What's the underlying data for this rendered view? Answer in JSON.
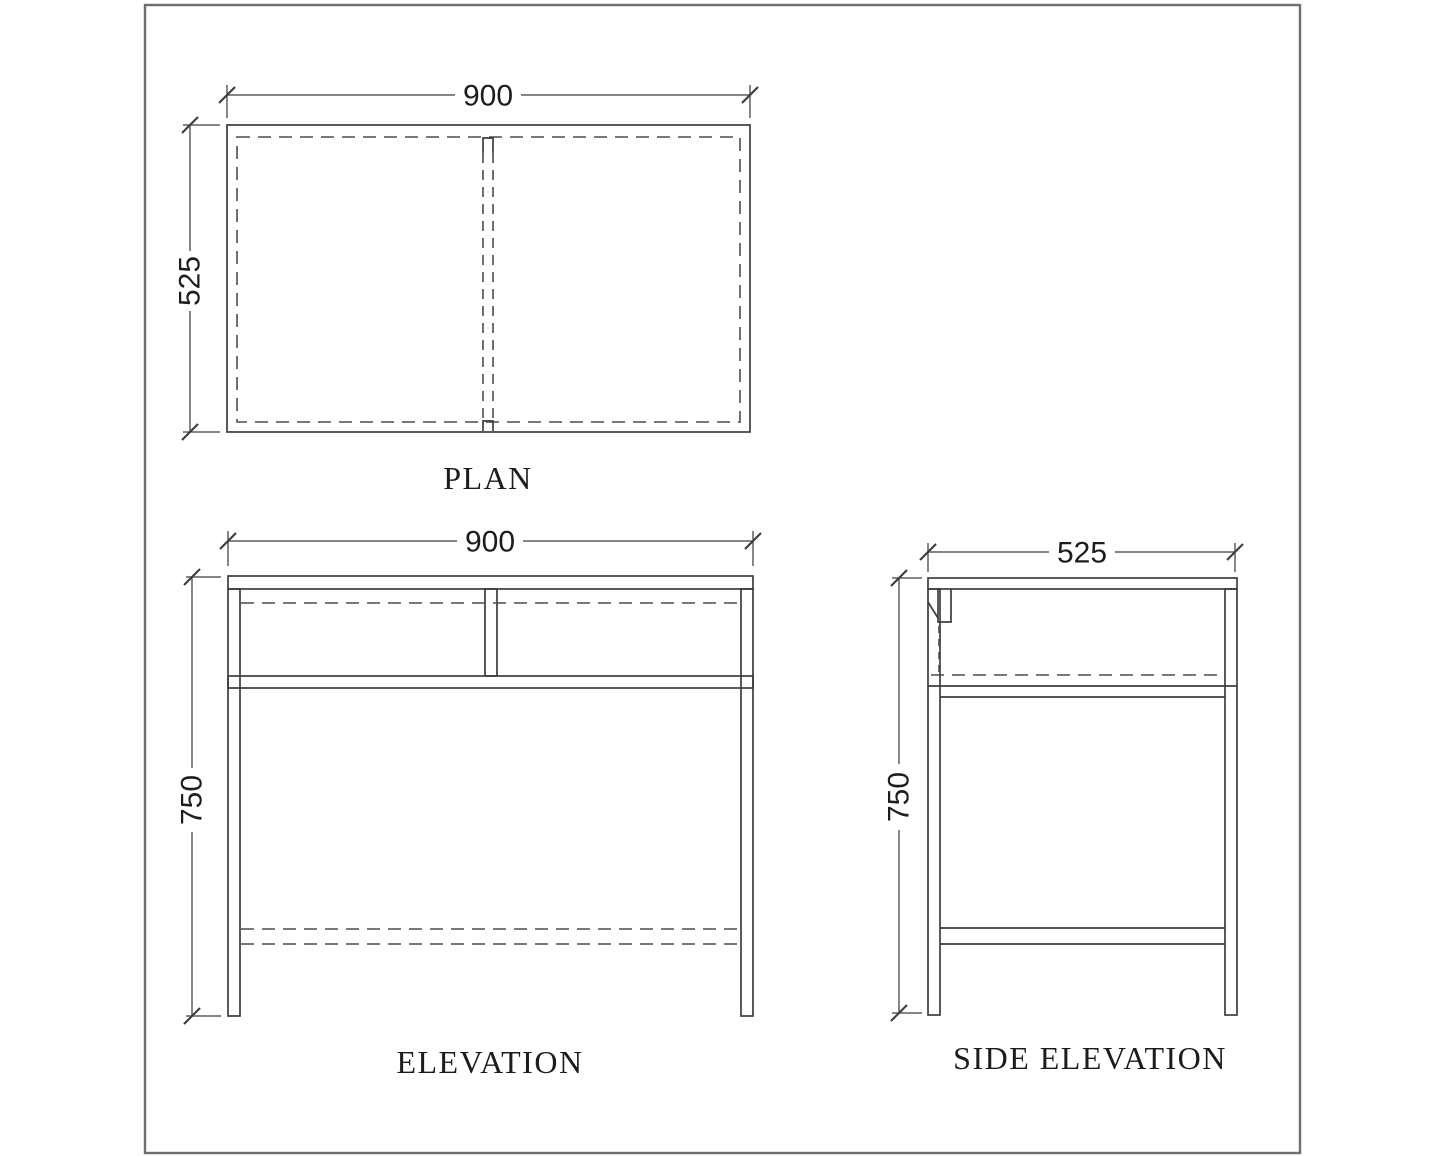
{
  "colors": {
    "bg": "#ffffff",
    "line": "#3d3d3d",
    "dash": "#4c4c4c",
    "border": "#6f6f6f",
    "text": "#1c1c1c"
  },
  "views": {
    "plan": {
      "label": "PLAN",
      "dim_width": "900",
      "dim_depth": "525"
    },
    "elevation": {
      "label": "ELEVATION",
      "dim_width": "900",
      "dim_height": "750"
    },
    "side": {
      "label": "SIDE ELEVATION",
      "dim_depth": "525",
      "dim_height": "750"
    }
  }
}
